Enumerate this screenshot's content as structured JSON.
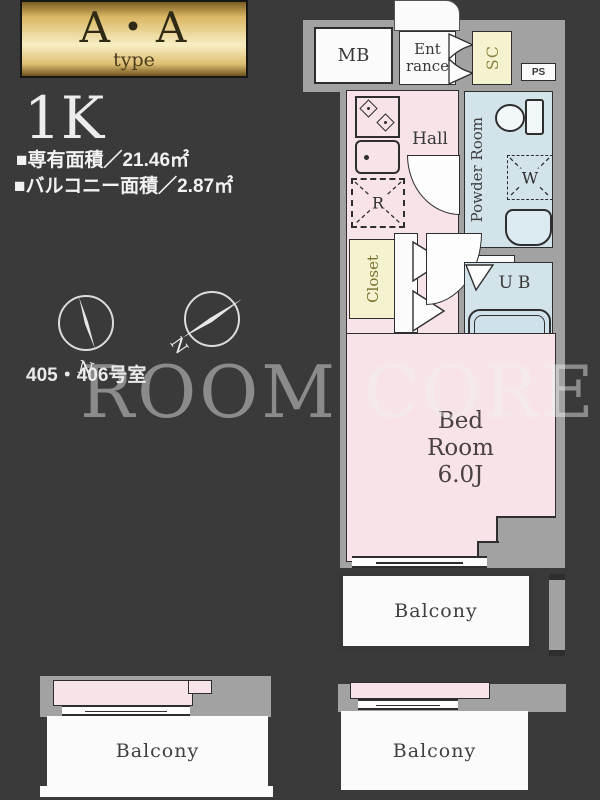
{
  "colors": {
    "background": "#3a3a3a",
    "common_area_gray": "#a2a2a2",
    "room_pink": "#f8e3e8",
    "wet_area_blue": "#d3e3ea",
    "storage_yellow": "#f5f2cf",
    "balcony_white": "#fbfbfb",
    "badge_gold": "#d9b763",
    "outline": "#2e2e2e"
  },
  "header": {
    "badge": {
      "title": "A・A",
      "subtitle": "type"
    },
    "layout_type": "1K",
    "exclusive_area": "■専有面積／21.46㎡",
    "balcony_area": "■バルコニー面積／2.87㎡",
    "room_numbers": "405・406号室"
  },
  "watermark": "ROOM CORE",
  "compass": {
    "north_label_left": "N",
    "north_label_right": "N"
  },
  "plan": {
    "mb": "MB",
    "entrance": {
      "line1": "Ent",
      "line2": "rance"
    },
    "sc": "SC",
    "ps": "PS",
    "hall": "Hall",
    "powder_room": "Powder Room",
    "closet": "Closet",
    "ub": "UB",
    "refrigerator": "R",
    "washer": "W",
    "bedroom": {
      "line1": "Bed",
      "line2": "Room",
      "line3": "6.0J"
    },
    "balcony_center": "Balcony",
    "balcony_bottom_left": "Balcony",
    "balcony_bottom_right": "Balcony"
  }
}
